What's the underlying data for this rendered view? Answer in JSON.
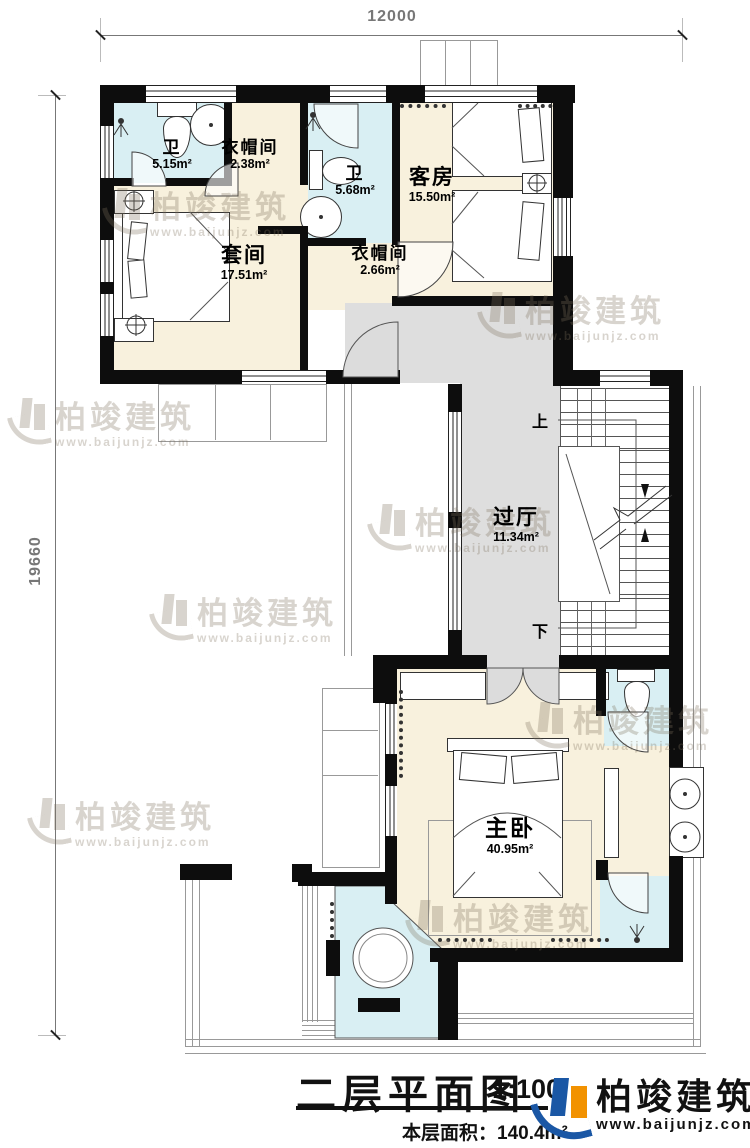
{
  "colors": {
    "floor_cream": "#f8f1dd",
    "floor_blue": "#d9eff3",
    "floor_gray": "#dedede",
    "wall": "#0d0d0d",
    "logo_blue": "#1a57a5",
    "logo_orange": "#f29200"
  },
  "dimensions": {
    "width": "12000",
    "height": "19660"
  },
  "rooms": {
    "bath1": {
      "name": "卫",
      "area": "5.15m²"
    },
    "closet1": {
      "name": "衣帽间",
      "area": "2.38m²"
    },
    "bath2": {
      "name": "卫",
      "area": "5.68m²"
    },
    "guest": {
      "name": "客房",
      "area": "15.50m²"
    },
    "suite": {
      "name": "套间",
      "area": "17.51m²"
    },
    "closet2": {
      "name": "衣帽间",
      "area": "2.66m²"
    },
    "hall": {
      "name": "过厅",
      "area": "11.34m²"
    },
    "master": {
      "name": "主卧",
      "area": "40.95m²"
    }
  },
  "stairs": {
    "up": "上",
    "down": "下"
  },
  "titleblock": {
    "title": "二层平面图",
    "scale": "1:100",
    "floor_area": "本层面积：140.4m²"
  },
  "brand": {
    "name": "柏竣建筑",
    "url": "www.baijunjz.com"
  },
  "watermark": {
    "brand": "柏竣建筑",
    "url": "www.baijunjz.com"
  }
}
